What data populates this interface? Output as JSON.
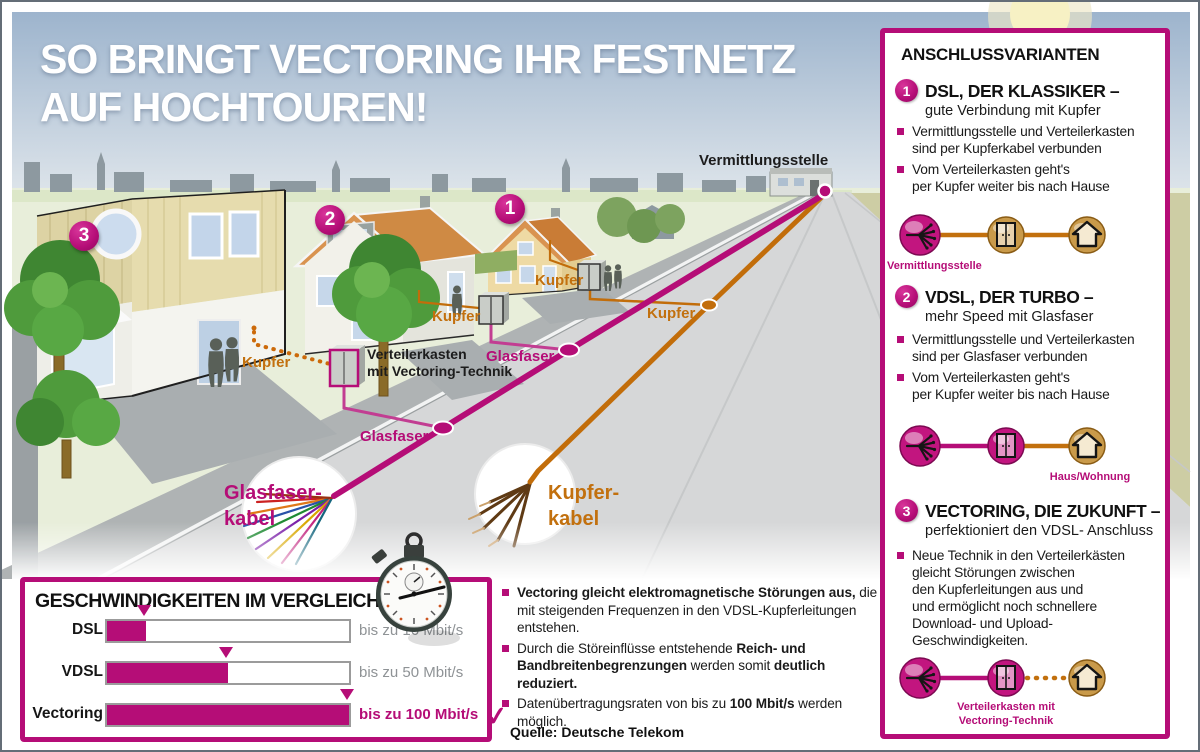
{
  "colors": {
    "magenta": "#b50d77",
    "copper": "#c2700e"
  },
  "title": {
    "line1": "SO BRINGT VECTORING IHR FESTNETZ",
    "line2": "AUF HOCHTOUREN!"
  },
  "scene": {
    "vermittlungsstelle_label": "Vermittlungsstelle",
    "kupfer_label": "Kupfer",
    "glasfaser_label": "Glasfaser",
    "verteilerkasten_label_line1": "Verteilerkasten",
    "verteilerkasten_label_line2": "mit Vectoring-Technik",
    "glasfaser_kabel_line1": "Glasfaser-",
    "glasfaser_kabel_line2": "kabel",
    "kupfer_kabel_line1": "Kupfer-",
    "kupfer_kabel_line2": "kabel",
    "house_numbers": [
      "1",
      "2",
      "3"
    ]
  },
  "chart": {
    "title": "GESCHWINDIGKEITEN IM VERGLEICH",
    "rows": [
      {
        "label": "DSL",
        "value": 16,
        "value_label": "bis zu 16 Mbit/s",
        "highlight": false
      },
      {
        "label": "VDSL",
        "value": 50,
        "value_label": "bis zu 50 Mbit/s",
        "highlight": false
      },
      {
        "label": "Vectoring",
        "value": 100,
        "value_label": "bis zu 100 Mbit/s",
        "highlight": true
      }
    ],
    "checkmark": "✓"
  },
  "chart_data": {
    "type": "bar",
    "title": "GESCHWINDIGKEITEN IM VERGLEICH",
    "categories": [
      "DSL",
      "VDSL",
      "Vectoring"
    ],
    "values": [
      16,
      50,
      100
    ],
    "unit": "Mbit/s",
    "value_labels": [
      "bis zu 16 Mbit/s",
      "bis zu 50 Mbit/s",
      "bis zu 100 Mbit/s"
    ],
    "xlim": [
      0,
      100
    ],
    "bar_color": "#b50d77",
    "legend": "none",
    "grid": false
  },
  "notes": {
    "bullets": [
      [
        {
          "t": "Vectoring gleicht elektromagnetische Störungen aus,",
          "b": true
        },
        {
          "t": " die mit steigenden Frequenzen in den VDSL-Kupferleitungen entstehen.",
          "b": false
        }
      ],
      [
        {
          "t": "Durch die Störeinflüsse entstehende ",
          "b": false
        },
        {
          "t": "Reich- und Bandbreitenbegrenzungen",
          "b": true
        },
        {
          "t": " werden somit ",
          "b": false
        },
        {
          "t": "deutlich reduziert.",
          "b": true
        }
      ],
      [
        {
          "t": "Datenübertragungsraten von bis zu ",
          "b": false
        },
        {
          "t": "100 Mbit/s",
          "b": true
        },
        {
          "t": " werden möglich.",
          "b": false
        }
      ]
    ],
    "source": "Quelle: Deutsche Telekom"
  },
  "sidebar": {
    "title": "ANSCHLUSSVARIANTEN",
    "items": [
      {
        "number": "1",
        "heading": "DSL, DER KLASSIKER –",
        "subheading": "gute Verbindung mit Kupfer",
        "bullets": [
          [
            "Vermittlungsstelle und Verteilerkasten",
            "sind per Kupferkabel verbunden"
          ],
          [
            "Vom Verteilerkasten geht's",
            "per Kupfer weiter bis nach Hause"
          ]
        ],
        "icon_label": "Vermittlungsstelle"
      },
      {
        "number": "2",
        "heading": "VDSL, DER TURBO –",
        "subheading": "mehr Speed mit Glasfaser",
        "bullets": [
          [
            "Vermittlungsstelle und Verteilerkasten",
            "sind per Glasfaser verbunden"
          ],
          [
            "Vom Verteilerkasten geht's",
            "per Kupfer weiter bis nach Hause"
          ]
        ],
        "icon_label": "Haus/Wohnung"
      },
      {
        "number": "3",
        "heading": "VECTORING, DIE ZUKUNFT –",
        "subheading": "perfektioniert den VDSL- Anschluss",
        "bullets": [
          [
            "Neue Technik in den Verteilerkästen",
            "gleicht Störungen zwischen",
            "den Kupferleitungen aus und",
            "und ermöglicht noch schnellere",
            "Download- und Upload-Geschwindigkeiten."
          ]
        ],
        "icon_label_line1": "Verteilerkasten mit",
        "icon_label_line2": "Vectoring-Technik"
      }
    ]
  }
}
